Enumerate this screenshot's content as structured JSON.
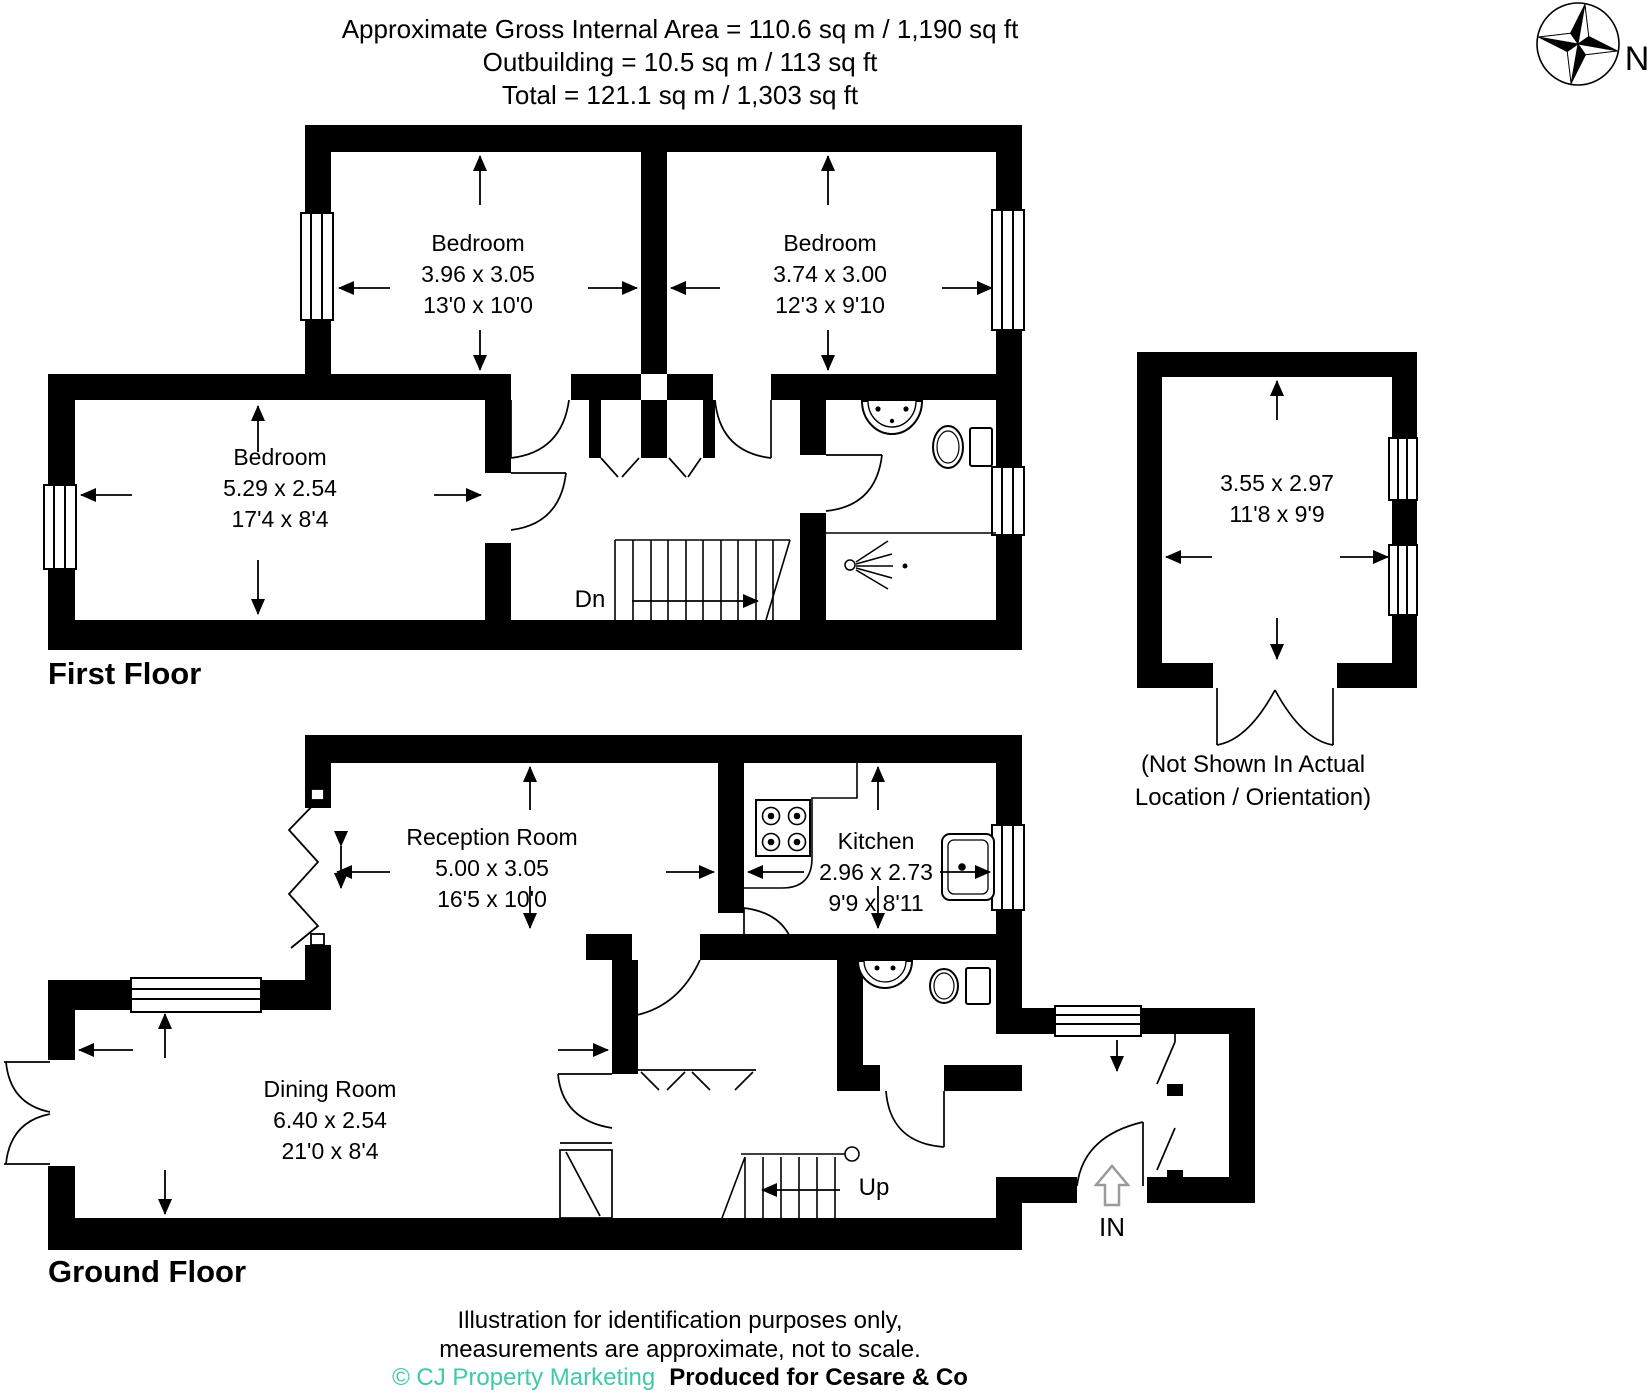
{
  "header": {
    "line1": "Approximate Gross Internal Area = 110.6 sq m / 1,190 sq ft",
    "line2": "Outbuilding = 10.5 sq m / 113 sq ft",
    "line3": "Total = 121.1 sq m / 1,303 sq ft"
  },
  "compass": {
    "north_label": "N"
  },
  "first_floor": {
    "title": "First Floor",
    "stairs_label": "Dn",
    "rooms": {
      "bedroom1": {
        "name": "Bedroom",
        "metric": "3.96 x 3.05",
        "imperial": "13'0 x 10'0"
      },
      "bedroom2": {
        "name": "Bedroom",
        "metric": "3.74 x 3.00",
        "imperial": "12'3 x 9'10"
      },
      "bedroom3": {
        "name": "Bedroom",
        "metric": "5.29 x 2.54",
        "imperial": "17'4 x 8'4"
      }
    }
  },
  "outbuilding": {
    "metric": "3.55 x 2.97",
    "imperial": "11'8 x 9'9",
    "note_line1": "(Not Shown In Actual",
    "note_line2": "Location / Orientation)"
  },
  "ground_floor": {
    "title": "Ground Floor",
    "stairs_label": "Up",
    "entrance_label": "IN",
    "rooms": {
      "reception": {
        "name": "Reception Room",
        "metric": "5.00 x 3.05",
        "imperial": "16'5 x 10'0"
      },
      "kitchen": {
        "name": "Kitchen",
        "metric": "2.96 x 2.73",
        "imperial": "9'9 x 8'11"
      },
      "dining": {
        "name": "Dining Room",
        "metric": "6.40 x 2.54",
        "imperial": "21'0 x 8'4"
      }
    }
  },
  "footer": {
    "line1": "Illustration for identification purposes only,",
    "line2": "measurements are approximate, not to scale.",
    "copyright": "© CJ Property Marketing",
    "produced": "Produced for Cesare & Co"
  },
  "colors": {
    "wall": "#000000",
    "accent_teal": "#3FC9A7"
  }
}
